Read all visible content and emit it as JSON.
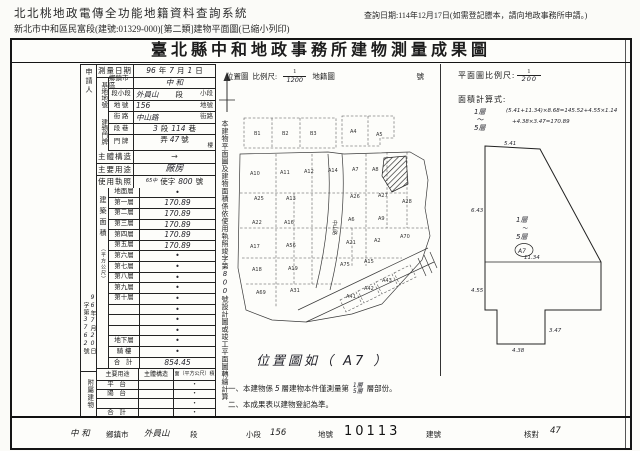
{
  "page_header": {
    "system_title": "北北桃地政電傳全功能地籍資料查詢系統",
    "print_subtitle": "新北市中和區民富段(建號:01329-000)[第二類]建物平面圖(已縮小列印)",
    "query_date_note": "查詢日期:114年12月17日(如需登記謄本，請向地政事務所申請。)"
  },
  "form_title": "臺北縣中和地政事務所建物測量成果圖",
  "left_table": {
    "applicant_label": "申請人",
    "survey": {
      "label": "測量日期",
      "year_hw": "96",
      "year_unit": "年",
      "month_hw": "7",
      "month_unit": "月",
      "day_hw": "1",
      "day_unit": "日"
    },
    "site": {
      "group_label": "基地地號",
      "township": {
        "label": "鄉鎮市區",
        "value_hw": "中 和"
      },
      "section": {
        "label": "段小段",
        "value_hw": "外員山",
        "suffix": "段",
        "sub_suffix": "小段"
      },
      "parcel": {
        "label": "地 號",
        "value_hw": "156",
        "suffix": "地號"
      }
    },
    "door": {
      "group_label": "建物門牌",
      "street": {
        "label": "街 路",
        "value_hw": "中山路",
        "suffix": "街路"
      },
      "seclane": {
        "label": "段 巷",
        "sec_hw": "3",
        "sec_unit": "段",
        "lane_hw": "114",
        "lane_unit": "巷"
      },
      "number": {
        "label": "門 牌",
        "alley_unit": "弄",
        "no_hw": "47",
        "no_unit": "號",
        "floor_unit": "樓"
      }
    },
    "structure": {
      "label": "主體構造",
      "value_hw": "→"
    },
    "usage": {
      "label": "主要用途",
      "value_hw": "廠房"
    },
    "license": {
      "label": "使用執照",
      "prefix_hw": "65中",
      "word": "使字",
      "no_hw": "800",
      "suffix": "號"
    },
    "area": {
      "group_label": "建築面積",
      "unit_label": "（平方公尺）",
      "floors": [
        {
          "label": "地面層",
          "value": "•"
        },
        {
          "label": "第一層",
          "value": "170.89"
        },
        {
          "label": "第二層",
          "value": "170.89"
        },
        {
          "label": "第三層",
          "value": "170.89"
        },
        {
          "label": "第四層",
          "value": "170.89"
        },
        {
          "label": "第五層",
          "value": "170.89"
        },
        {
          "label": "第六層",
          "value": "•"
        },
        {
          "label": "第七層",
          "value": "•"
        },
        {
          "label": "第八層",
          "value": "•"
        },
        {
          "label": "第九層",
          "value": "•"
        },
        {
          "label": "第十層",
          "value": "•"
        },
        {
          "label": "",
          "value": "•"
        },
        {
          "label": "",
          "value": "•"
        },
        {
          "label": "",
          "value": "•"
        },
        {
          "label": "地下層",
          "value": "•"
        },
        {
          "label": "騎 樓",
          "value": "•"
        }
      ],
      "total_label": "合 計",
      "total_value_hw": "854.45"
    },
    "receipt": {
      "no_pre": "字第",
      "no_hw": "3762",
      "no_post": "號",
      "date_y_hw": "96",
      "y": "年",
      "date_m_hw": "7",
      "m": "月",
      "date_d_hw": "20",
      "d": "日"
    },
    "annex": {
      "group_label": "附屬建物",
      "header": {
        "usage": "主要用途",
        "structure": "主體構造",
        "area": "面（平方公尺）積"
      },
      "rows": [
        {
          "label": "平 台",
          "value": "•"
        },
        {
          "label": "陽 台",
          "value": "•"
        },
        {
          "label": "",
          "value": "•"
        },
        {
          "label": "合 計",
          "value": "•"
        }
      ]
    }
  },
  "mid_note": {
    "top": "本建物平面圖及建物面積係依使用執照竣字第",
    "no_hw": "800",
    "bottom": "號設計圖或竣工平面圖轉繪計算"
  },
  "map_panel": {
    "header": {
      "title": "位置圖",
      "scale_label": "比例尺:",
      "num": "1",
      "den_hw": "1200",
      "sheet_label": "地籍圖",
      "no_label": "號"
    },
    "road_label": "中山路",
    "caption_hw": "位置圖如（ A7 ）",
    "note1": {
      "pre": "一、本建物係",
      "n_hw": "5",
      "mid": "層建物本件僅測量第",
      "f1_hw": "1層",
      "f2_hw": "5層",
      "post": "層部份。"
    },
    "note2": "二、本成果表以建物登記為準。",
    "parcels": [
      {
        "x": 22,
        "y": 27,
        "label": "B1"
      },
      {
        "x": 50,
        "y": 27,
        "label": "B2"
      },
      {
        "x": 78,
        "y": 27,
        "label": "B3"
      },
      {
        "x": 118,
        "y": 25,
        "label": "A4"
      },
      {
        "x": 144,
        "y": 28,
        "label": "A5"
      },
      {
        "x": 18,
        "y": 67,
        "label": "A10"
      },
      {
        "x": 48,
        "y": 66,
        "label": "A11"
      },
      {
        "x": 72,
        "y": 65,
        "label": "A12"
      },
      {
        "x": 96,
        "y": 64,
        "label": "A14"
      },
      {
        "x": 120,
        "y": 63,
        "label": "A7"
      },
      {
        "x": 140,
        "y": 63,
        "label": "A8"
      },
      {
        "x": 22,
        "y": 92,
        "label": "A25"
      },
      {
        "x": 54,
        "y": 92,
        "label": "A13"
      },
      {
        "x": 118,
        "y": 90,
        "label": "A26"
      },
      {
        "x": 146,
        "y": 89,
        "label": "A27"
      },
      {
        "x": 170,
        "y": 95,
        "label": "A28"
      },
      {
        "x": 20,
        "y": 116,
        "label": "A22"
      },
      {
        "x": 52,
        "y": 116,
        "label": "A16"
      },
      {
        "x": 116,
        "y": 113,
        "label": "A6"
      },
      {
        "x": 146,
        "y": 112,
        "label": "A9"
      },
      {
        "x": 18,
        "y": 140,
        "label": "A17"
      },
      {
        "x": 54,
        "y": 139,
        "label": "A56"
      },
      {
        "x": 114,
        "y": 136,
        "label": "A21"
      },
      {
        "x": 142,
        "y": 134,
        "label": "A2"
      },
      {
        "x": 168,
        "y": 130,
        "label": "A70"
      },
      {
        "x": 20,
        "y": 163,
        "label": "A18"
      },
      {
        "x": 56,
        "y": 162,
        "label": "A19"
      },
      {
        "x": 108,
        "y": 158,
        "label": "A75"
      },
      {
        "x": 132,
        "y": 155,
        "label": "A15"
      },
      {
        "x": 24,
        "y": 186,
        "label": "A69"
      },
      {
        "x": 58,
        "y": 184,
        "label": "A31"
      },
      {
        "x": 114,
        "y": 190,
        "label": "A41"
      },
      {
        "x": 132,
        "y": 182,
        "label": "A42"
      },
      {
        "x": 150,
        "y": 174,
        "label": "A43"
      }
    ]
  },
  "plan_panel": {
    "scale_label": "平面圖比例尺:",
    "num": "1",
    "den_hw": "200",
    "calc_label": "面積計算式:",
    "floors_hw_1": "1層",
    "tilde": "～",
    "floors_hw_2": "5層",
    "formula1_hw": "(5.41+11.34)×8.68=145.52+4.55×1.14",
    "formula2_hw": "+4.38×3.47=170.89",
    "mark_floor_1": "1層",
    "mark_floor_2": "5層",
    "mark_circle_hw": "A7",
    "dims": {
      "top": "5.41",
      "left_upper": "6.43",
      "mid": "11.34",
      "left_lower": "4.55",
      "tab_right": "3.47",
      "tab_bottom": "4.38"
    }
  },
  "footer": {
    "township_hw": "中 和",
    "township_label": "鄉鎮市",
    "section_hw": "外員山",
    "section_label": "段",
    "subsection_label": "小段",
    "subsection_hw": "156",
    "parcel_label": "地號",
    "parcel_no": "10113",
    "build_label": "建號",
    "check_label": "核對",
    "check_hw": "47"
  }
}
